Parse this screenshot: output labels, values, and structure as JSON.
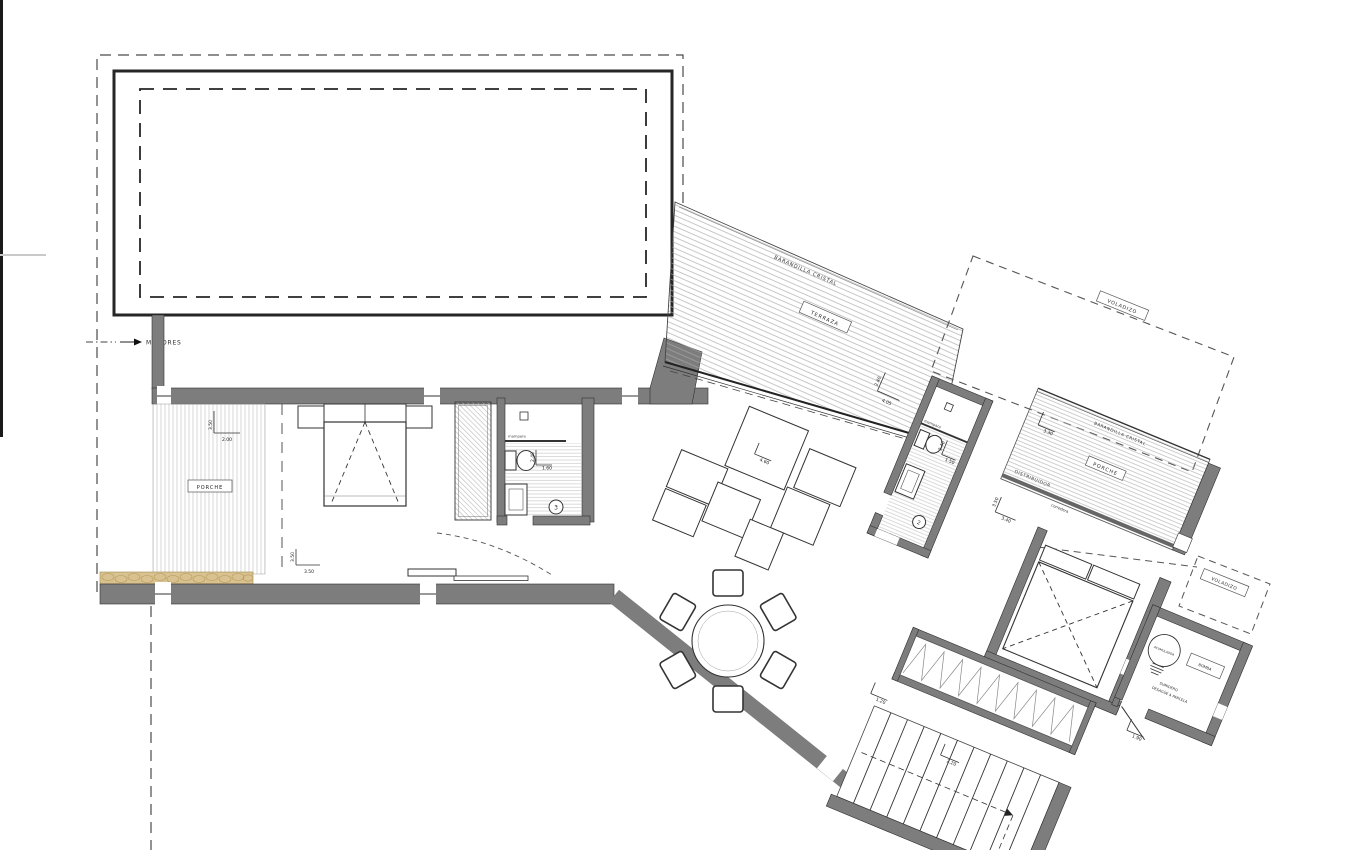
{
  "drawing": {
    "annotations": {
      "motores": "MOTORES",
      "porche_left": "PORCHE",
      "terraza": "TERRAZA",
      "barandilla_terraza": "BARANDILLA CRISTAL",
      "barandilla_porche": "BARANDILLA CRISTAL",
      "porche_right": "PORCHE",
      "corredera": "corredera",
      "voladizo_grande": "VOLADIZO",
      "voladizo_pequeno": "VOLADIZO",
      "distribuidor": "DISTRIBUIDOR",
      "mampara": "mampara",
      "acumulador": "ACUMULADOR",
      "bomba": "BOMBA",
      "sumidero_1": "SUMIDERO",
      "sumidero_2": "DESAGÜE A PARCELA",
      "bath3_badge": "3",
      "bath2_badge": "2"
    },
    "dimensions": {
      "porche_left_d": "3.50",
      "porche_left_w": "2.00",
      "bedroom1_a": "3.50",
      "bedroom1_b": "3.50",
      "bath3_len": "2.40",
      "bath3_wid": "1.60",
      "terraza_a": "2.40",
      "terraza_b": "4.05",
      "living": "4.60",
      "bath2_len": "2.40",
      "bath2_wid": "1.50",
      "hall_a": "3.50",
      "hall_b": "3.40",
      "porche_right": "3.30",
      "stairs": "2.20",
      "stairs_door": "1.20",
      "utility_door": "1.90"
    },
    "colors": {
      "wall": "#7d7d7d",
      "line": "#2e2e2e",
      "sand": "#d9c28f",
      "dash": "#4a4a4a",
      "hatch": "#b5b5b5"
    }
  }
}
